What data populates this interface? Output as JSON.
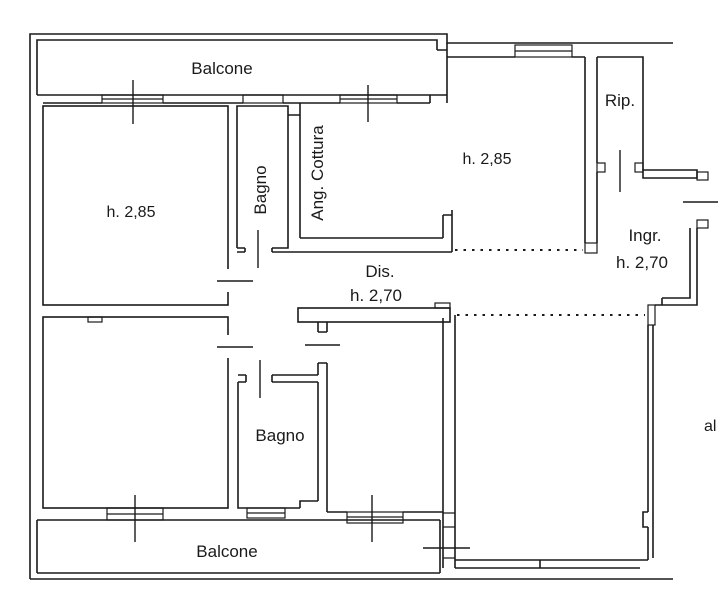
{
  "drawing": {
    "type": "floor-plan",
    "language": "it",
    "colors": {
      "line": "#1a1a1a",
      "background": "#ffffff"
    },
    "labels": {
      "balcone_top": "Balcone",
      "balcone_bottom": "Balcone",
      "bedroom_top_left_height": "h. 2,85",
      "living_room_height": "h. 2,85",
      "bagno_top": "Bagno",
      "bagno_bottom": "Bagno",
      "ang_cottura": "Ang. Cottura",
      "ripostiglio": "Rip.",
      "ingresso": "Ingr.",
      "ingresso_height": "h. 2,70",
      "disimpegno": "Dis.",
      "disimpegno_height": "h. 2,70",
      "right_edge_text": "al"
    },
    "height_annotations": [
      "h. 2,85",
      "h. 2,85",
      "h. 2,70",
      "h. 2,70"
    ]
  }
}
